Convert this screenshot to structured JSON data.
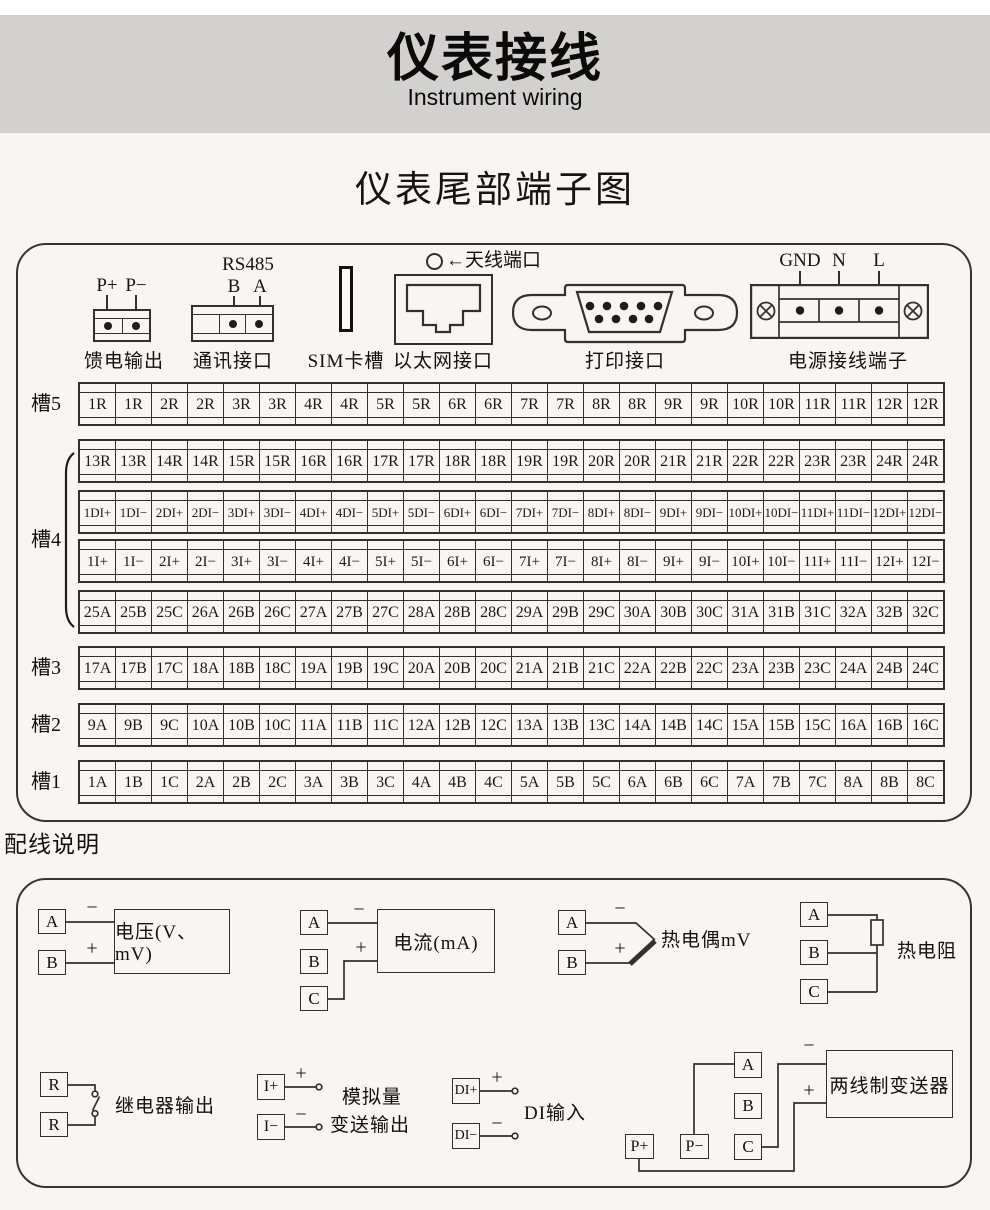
{
  "header": {
    "title": "仪表接线",
    "subtitle": "Instrument wiring"
  },
  "section_title": "仪表尾部端子图",
  "connectors": {
    "feed": {
      "pins": [
        "P+",
        "P−"
      ],
      "label": "馈电输出"
    },
    "comm": {
      "bus": "RS485",
      "pins": [
        "B",
        "A"
      ],
      "label": "通讯接口"
    },
    "sim": {
      "label": "SIM卡槽"
    },
    "ethernet": {
      "label": "以太网接口"
    },
    "antenna": {
      "label": "←天线端口"
    },
    "printer": {
      "label": "打印接口"
    },
    "power": {
      "pins": [
        "GND",
        "N",
        "L"
      ],
      "label": "电源接线端子"
    }
  },
  "slots": {
    "slot5_label": "槽5",
    "slot4_label": "槽4",
    "slot3_label": "槽3",
    "slot2_label": "槽2",
    "slot1_label": "槽1",
    "rows": [
      {
        "cells": [
          "1R",
          "1R",
          "2R",
          "2R",
          "3R",
          "3R",
          "4R",
          "4R",
          "5R",
          "5R",
          "6R",
          "6R",
          "7R",
          "7R",
          "8R",
          "8R",
          "9R",
          "9R",
          "10R",
          "10R",
          "11R",
          "11R",
          "12R",
          "12R"
        ]
      },
      {
        "cells": [
          "13R",
          "13R",
          "14R",
          "14R",
          "15R",
          "15R",
          "16R",
          "16R",
          "17R",
          "17R",
          "18R",
          "18R",
          "19R",
          "19R",
          "20R",
          "20R",
          "21R",
          "21R",
          "22R",
          "22R",
          "23R",
          "23R",
          "24R",
          "24R"
        ]
      },
      {
        "cells": [
          "1DI+",
          "1DI−",
          "2DI+",
          "2DI−",
          "3DI+",
          "3DI−",
          "4DI+",
          "4DI−",
          "5DI+",
          "5DI−",
          "6DI+",
          "6DI−",
          "7DI+",
          "7DI−",
          "8DI+",
          "8DI−",
          "9DI+",
          "9DI−",
          "10DI+",
          "10DI−",
          "11DI+",
          "11DI−",
          "12DI+",
          "12DI−"
        ]
      },
      {
        "cells": [
          "1I+",
          "1I−",
          "2I+",
          "2I−",
          "3I+",
          "3I−",
          "4I+",
          "4I−",
          "5I+",
          "5I−",
          "6I+",
          "6I−",
          "7I+",
          "7I−",
          "8I+",
          "8I−",
          "9I+",
          "9I−",
          "10I+",
          "10I−",
          "11I+",
          "11I−",
          "12I+",
          "12I−"
        ]
      },
      {
        "cells": [
          "25A",
          "25B",
          "25C",
          "26A",
          "26B",
          "26C",
          "27A",
          "27B",
          "27C",
          "28A",
          "28B",
          "28C",
          "29A",
          "29B",
          "29C",
          "30A",
          "30B",
          "30C",
          "31A",
          "31B",
          "31C",
          "32A",
          "32B",
          "32C"
        ]
      },
      {
        "cells": [
          "17A",
          "17B",
          "17C",
          "18A",
          "18B",
          "18C",
          "19A",
          "19B",
          "19C",
          "20A",
          "20B",
          "20C",
          "21A",
          "21B",
          "21C",
          "22A",
          "22B",
          "22C",
          "23A",
          "23B",
          "23C",
          "24A",
          "24B",
          "24C"
        ]
      },
      {
        "cells": [
          "9A",
          "9B",
          "9C",
          "10A",
          "10B",
          "10C",
          "11A",
          "11B",
          "11C",
          "12A",
          "12B",
          "12C",
          "13A",
          "13B",
          "13C",
          "14A",
          "14B",
          "14C",
          "15A",
          "15B",
          "15C",
          "16A",
          "16B",
          "16C"
        ]
      },
      {
        "cells": [
          "1A",
          "1B",
          "1C",
          "2A",
          "2B",
          "2C",
          "3A",
          "3B",
          "3C",
          "4A",
          "4B",
          "4C",
          "5A",
          "5B",
          "5C",
          "6A",
          "6B",
          "6C",
          "7A",
          "7B",
          "7C",
          "8A",
          "8B",
          "8C"
        ]
      }
    ]
  },
  "wiring": {
    "section_title": "配线说明",
    "voltage": {
      "terminals": [
        "A",
        "B"
      ],
      "signs": [
        "−",
        "+"
      ],
      "label": "电压(V、mV)"
    },
    "current": {
      "terminals": [
        "A",
        "B",
        "C"
      ],
      "signs": [
        "−",
        "+"
      ],
      "label": "电流(mA)"
    },
    "thermocouple": {
      "terminals": [
        "A",
        "B"
      ],
      "signs": [
        "−",
        "+"
      ],
      "label": "热电偶mV"
    },
    "rtd": {
      "terminals": [
        "A",
        "B",
        "C"
      ],
      "label": "热电阻"
    },
    "relay": {
      "terminals": [
        "R",
        "R"
      ],
      "label": "继电器输出"
    },
    "analog": {
      "terminals": [
        "I+",
        "I−"
      ],
      "signs": [
        "+",
        "−"
      ],
      "label_line1": "模拟量",
      "label_line2": "变送输出"
    },
    "di": {
      "terminals": [
        "DI+",
        "DI−"
      ],
      "signs": [
        "+",
        "−"
      ],
      "label": "DI输入"
    },
    "transmitter": {
      "terminals": [
        "A",
        "B",
        "C"
      ],
      "power_pins": [
        "P+",
        "P−"
      ],
      "signs": [
        "−",
        "+"
      ],
      "label": "两线制变送器"
    }
  }
}
